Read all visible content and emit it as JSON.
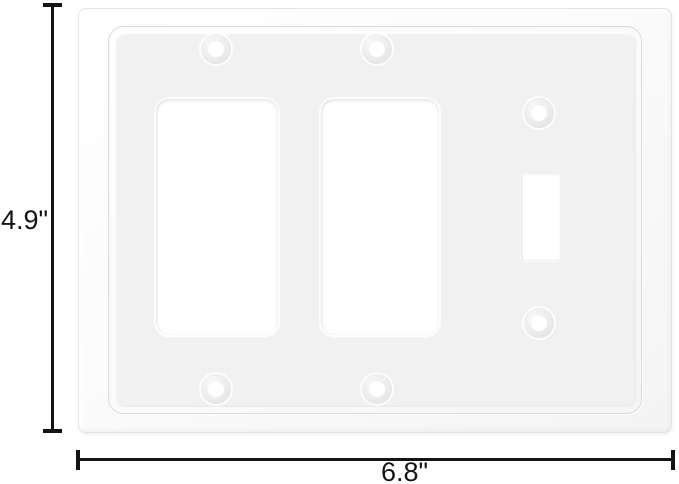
{
  "image": {
    "type": "product-dimension-diagram",
    "subject": "white 3-gang wall plate with two rocker openings and one toggle switch opening",
    "background_color": "#ffffff"
  },
  "dimensions": {
    "height": {
      "label": "4.9\""
    },
    "width": {
      "label": "6.8\""
    }
  },
  "plate": {
    "body_color": "#fbfbfb",
    "face_color": "#f1f1f1",
    "edge_color": "#e3e3e3",
    "openings": [
      {
        "type": "rocker",
        "position": "left"
      },
      {
        "type": "rocker",
        "position": "middle"
      },
      {
        "type": "toggle",
        "position": "right"
      }
    ],
    "screw_hole_count": 6
  },
  "annotation": {
    "line_color": "#141414"
  }
}
